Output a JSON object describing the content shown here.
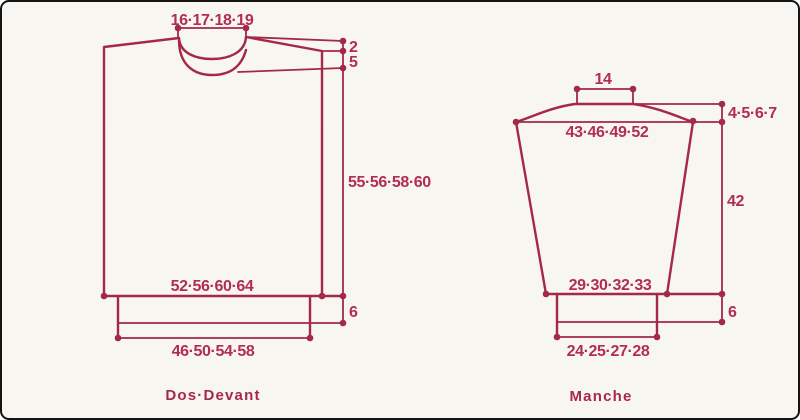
{
  "page": {
    "background_color": "#f8f6f1",
    "line_color": "#a42947",
    "text_color": "#b32c52",
    "border_color": "#141414"
  },
  "pieces": [
    {
      "id": "dos-devant",
      "label": "Dos·Devant",
      "measurements": {
        "neck_width": "16·17·18·19",
        "shoulder_drop": "2",
        "front_neck_depth": "5",
        "body_length": "55·56·58·60",
        "body_width": "52·56·60·64",
        "rib_height": "6",
        "rib_width": "46·50·54·58"
      }
    },
    {
      "id": "manche",
      "label": "Manche",
      "measurements": {
        "cap_top_width": "14",
        "top_width": "43·46·49·52",
        "cap_height": "4·5·6·7",
        "sleeve_length": "42",
        "bottom_width": "29·30·32·33",
        "cuff_height": "6",
        "cuff_width": "24·25·27·28"
      }
    }
  ]
}
